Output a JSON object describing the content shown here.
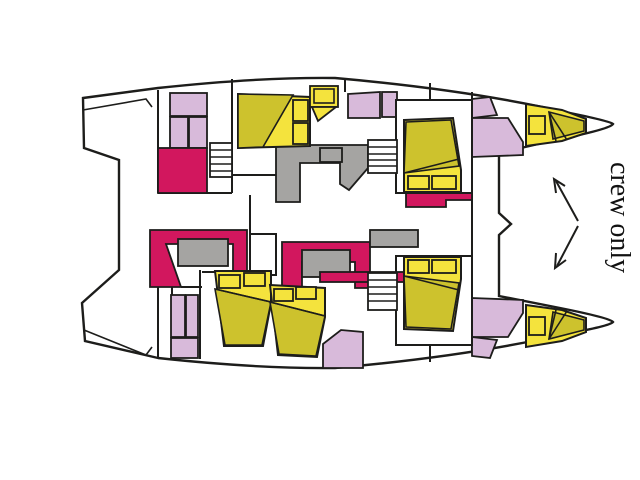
{
  "figure": {
    "kind": "catamaran-deck-plan",
    "crew_label": "crew only"
  },
  "colors": {
    "hull": "#ffffff",
    "outline": "#1d1d1b",
    "bed": "#cdc22d",
    "bedlight": "#f4e33d",
    "seat": "#d2175e",
    "bath": "#d8bada",
    "counter": "#a5a4a2",
    "text": "#111111"
  }
}
